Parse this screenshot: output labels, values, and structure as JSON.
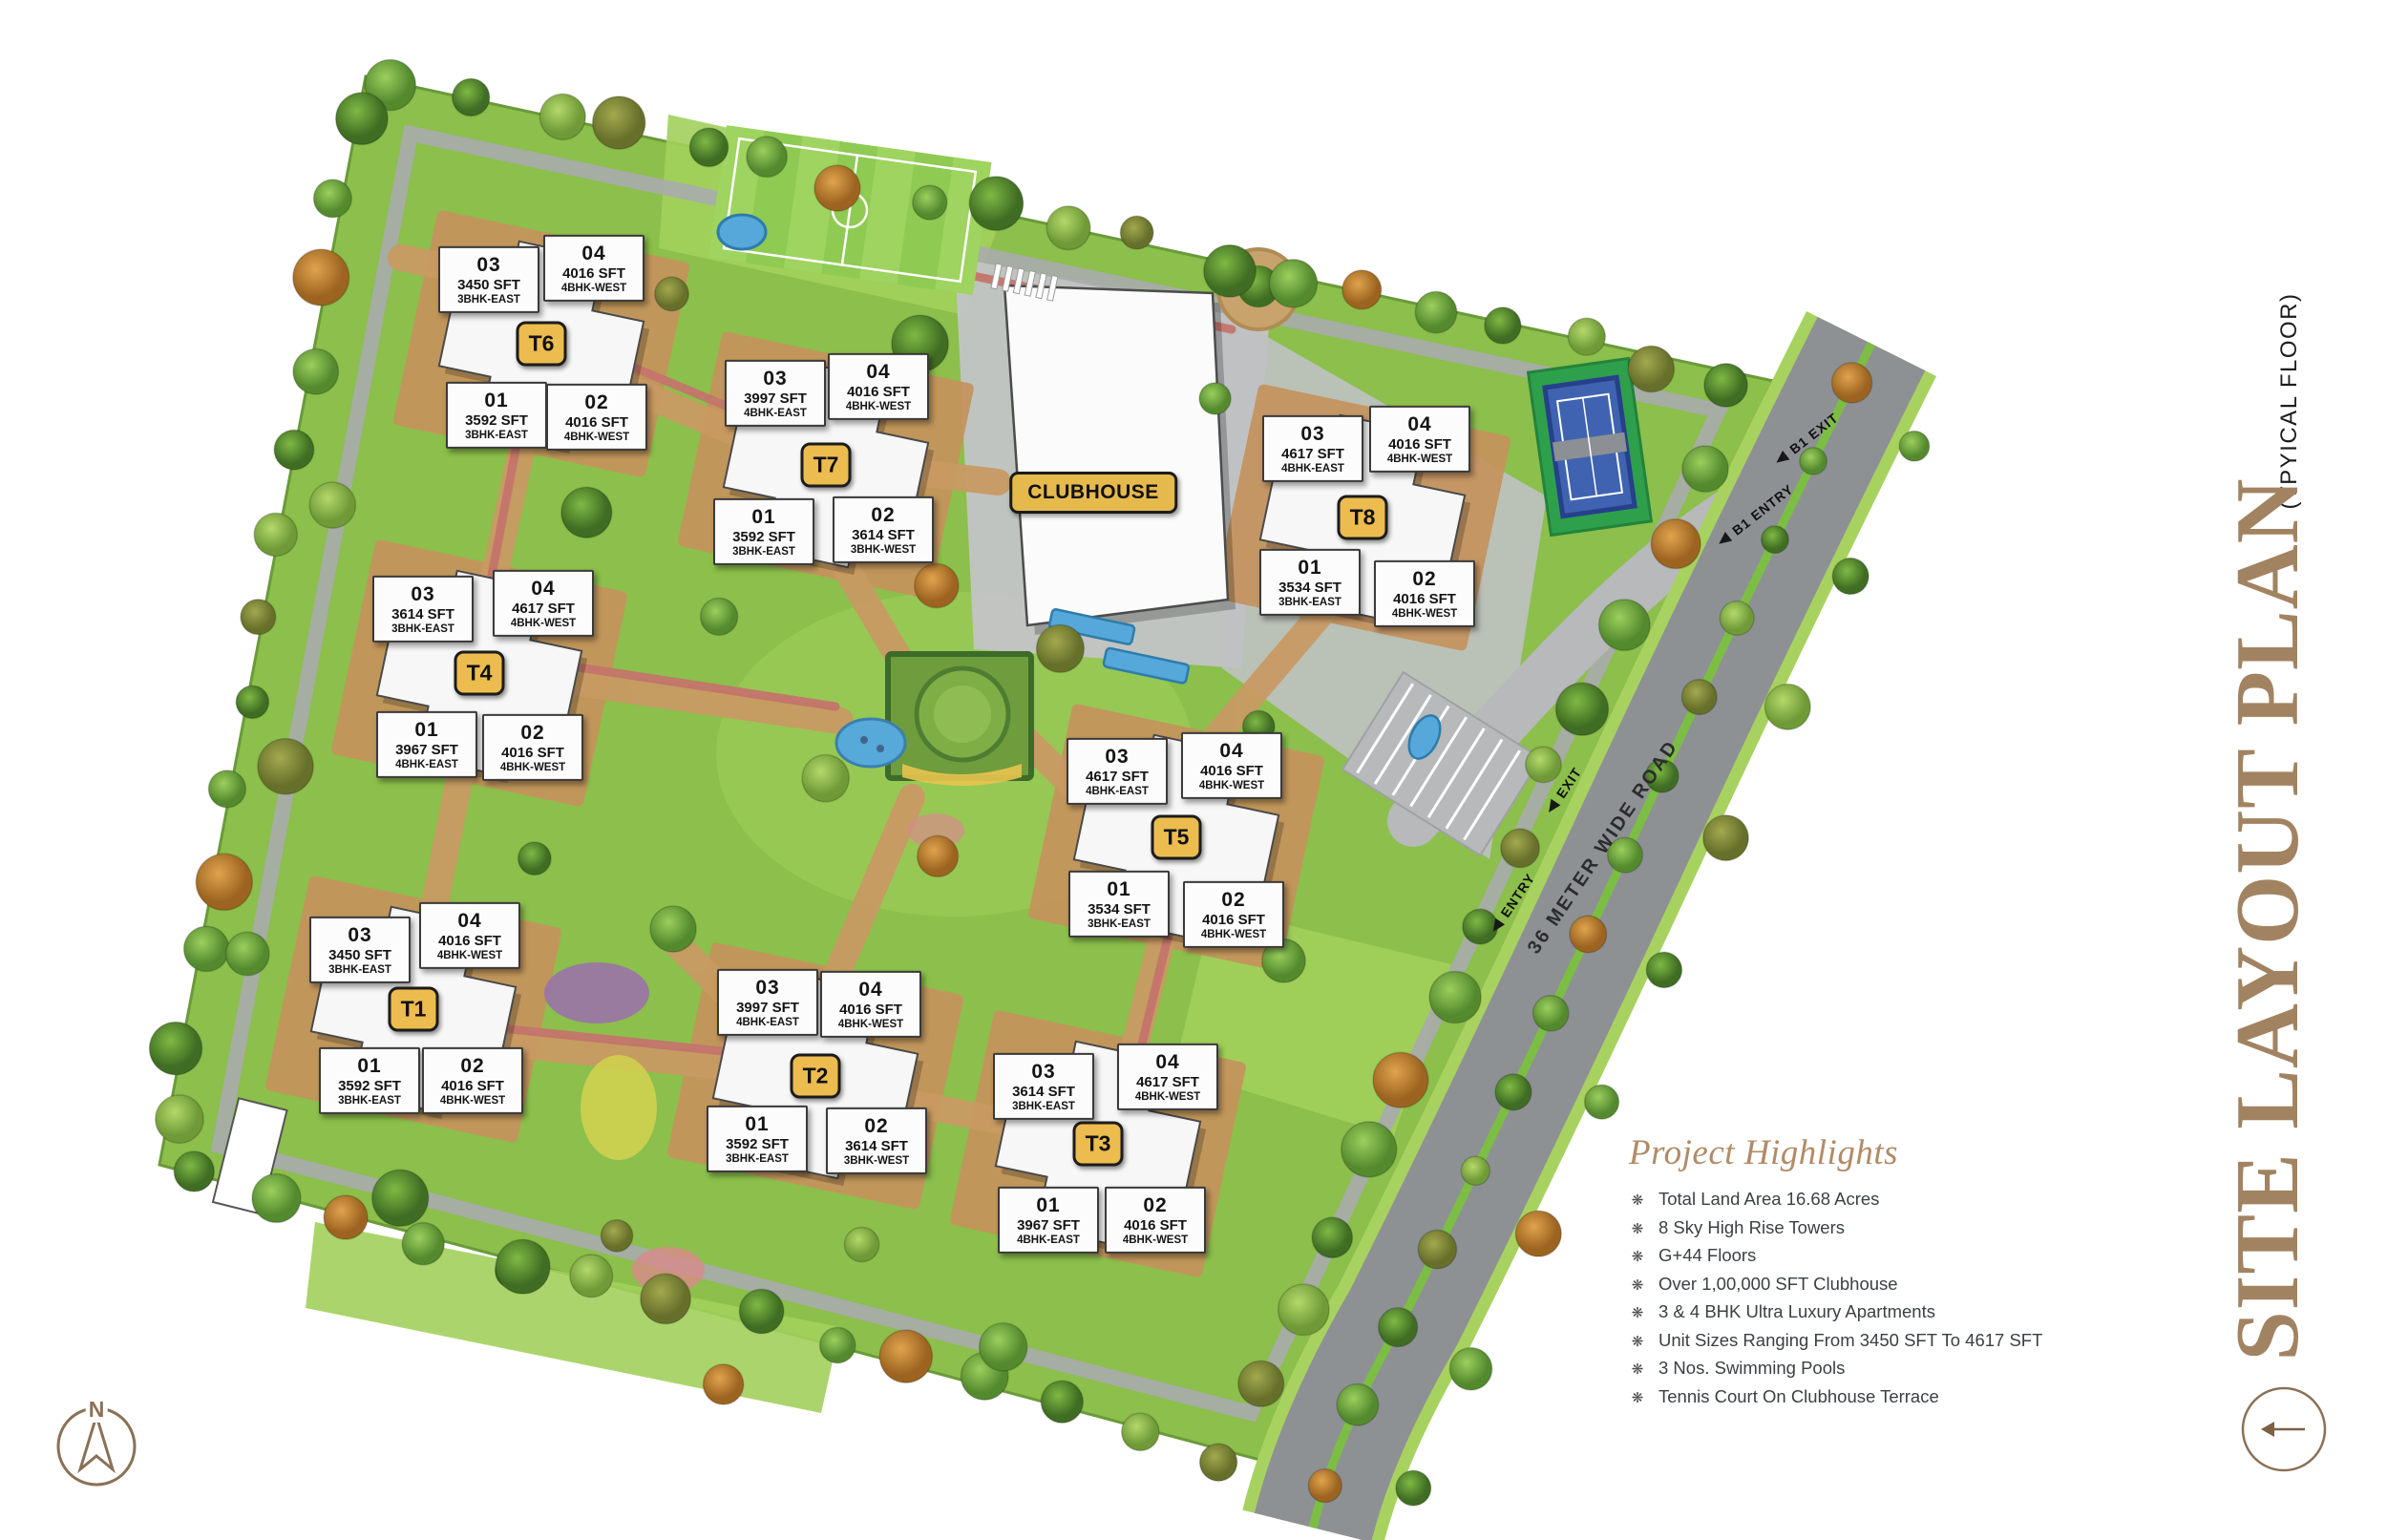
{
  "title": {
    "main": "SITE LAYOUT PLAN",
    "sub": "(TPYICAL FLOOR)",
    "main_color": "#a28361"
  },
  "site_plan": {
    "clubhouse_label": "CLUBHOUSE",
    "road_label": "36 METER WIDE ROAD",
    "entry_label": "ENTRY",
    "exit_label": "EXIT",
    "b1_entry_label": "B1 ENTRY",
    "b1_exit_label": "B1 EXIT",
    "compass_n": "N"
  },
  "colors": {
    "lawn_green": "#8cbf4b",
    "paving_tan": "#c6935d",
    "road_gray": "#8e9194",
    "badge_gold": "#ecbc4f",
    "title_brown": "#a28361",
    "accent_brown": "#8a7156"
  },
  "towers": [
    {
      "id": "T1",
      "units": [
        {
          "no": "03",
          "sft": "3450 SFT",
          "type": "3BHK-EAST"
        },
        {
          "no": "04",
          "sft": "4016 SFT",
          "type": "4BHK-WEST"
        },
        {
          "no": "01",
          "sft": "3592 SFT",
          "type": "3BHK-EAST"
        },
        {
          "no": "02",
          "sft": "4016 SFT",
          "type": "4BHK-WEST"
        }
      ]
    },
    {
      "id": "T2",
      "units": [
        {
          "no": "03",
          "sft": "3997 SFT",
          "type": "4BHK-EAST"
        },
        {
          "no": "04",
          "sft": "4016 SFT",
          "type": "4BHK-WEST"
        },
        {
          "no": "01",
          "sft": "3592 SFT",
          "type": "3BHK-EAST"
        },
        {
          "no": "02",
          "sft": "3614 SFT",
          "type": "3BHK-WEST"
        }
      ]
    },
    {
      "id": "T3",
      "units": [
        {
          "no": "03",
          "sft": "3614 SFT",
          "type": "3BHK-EAST"
        },
        {
          "no": "04",
          "sft": "4617 SFT",
          "type": "4BHK-WEST"
        },
        {
          "no": "01",
          "sft": "3967 SFT",
          "type": "4BHK-EAST"
        },
        {
          "no": "02",
          "sft": "4016 SFT",
          "type": "4BHK-WEST"
        }
      ]
    },
    {
      "id": "T4",
      "units": [
        {
          "no": "03",
          "sft": "3614 SFT",
          "type": "3BHK-EAST"
        },
        {
          "no": "04",
          "sft": "4617 SFT",
          "type": "4BHK-WEST"
        },
        {
          "no": "01",
          "sft": "3967 SFT",
          "type": "4BHK-EAST"
        },
        {
          "no": "02",
          "sft": "4016 SFT",
          "type": "4BHK-WEST"
        }
      ]
    },
    {
      "id": "T5",
      "units": [
        {
          "no": "03",
          "sft": "4617 SFT",
          "type": "4BHK-EAST"
        },
        {
          "no": "04",
          "sft": "4016 SFT",
          "type": "4BHK-WEST"
        },
        {
          "no": "01",
          "sft": "3534 SFT",
          "type": "3BHK-EAST"
        },
        {
          "no": "02",
          "sft": "4016 SFT",
          "type": "4BHK-WEST"
        }
      ]
    },
    {
      "id": "T6",
      "units": [
        {
          "no": "03",
          "sft": "3450 SFT",
          "type": "3BHK-EAST"
        },
        {
          "no": "04",
          "sft": "4016 SFT",
          "type": "4BHK-WEST"
        },
        {
          "no": "01",
          "sft": "3592 SFT",
          "type": "3BHK-EAST"
        },
        {
          "no": "02",
          "sft": "4016 SFT",
          "type": "4BHK-WEST"
        }
      ]
    },
    {
      "id": "T7",
      "units": [
        {
          "no": "03",
          "sft": "3997 SFT",
          "type": "4BHK-EAST"
        },
        {
          "no": "04",
          "sft": "4016 SFT",
          "type": "4BHK-WEST"
        },
        {
          "no": "01",
          "sft": "3592 SFT",
          "type": "3BHK-EAST"
        },
        {
          "no": "02",
          "sft": "3614 SFT",
          "type": "3BHK-WEST"
        }
      ]
    },
    {
      "id": "T8",
      "units": [
        {
          "no": "03",
          "sft": "4617 SFT",
          "type": "4BHK-EAST"
        },
        {
          "no": "04",
          "sft": "4016 SFT",
          "type": "4BHK-WEST"
        },
        {
          "no": "01",
          "sft": "3534 SFT",
          "type": "3BHK-EAST"
        },
        {
          "no": "02",
          "sft": "4016 SFT",
          "type": "4BHK-WEST"
        }
      ]
    }
  ],
  "highlights": {
    "heading": "Project Highlights",
    "bullet": "❋",
    "items": [
      "Total Land Area 16.68 Acres",
      "8 Sky High Rise Towers",
      "G+44 Floors",
      "Over 1,00,000 SFT Clubhouse",
      "3 & 4 BHK Ultra Luxury Apartments",
      "Unit Sizes Ranging From 3450 SFT To 4617 SFT",
      "3 Nos. Swimming Pools",
      "Tennis Court On Clubhouse Terrace"
    ]
  }
}
